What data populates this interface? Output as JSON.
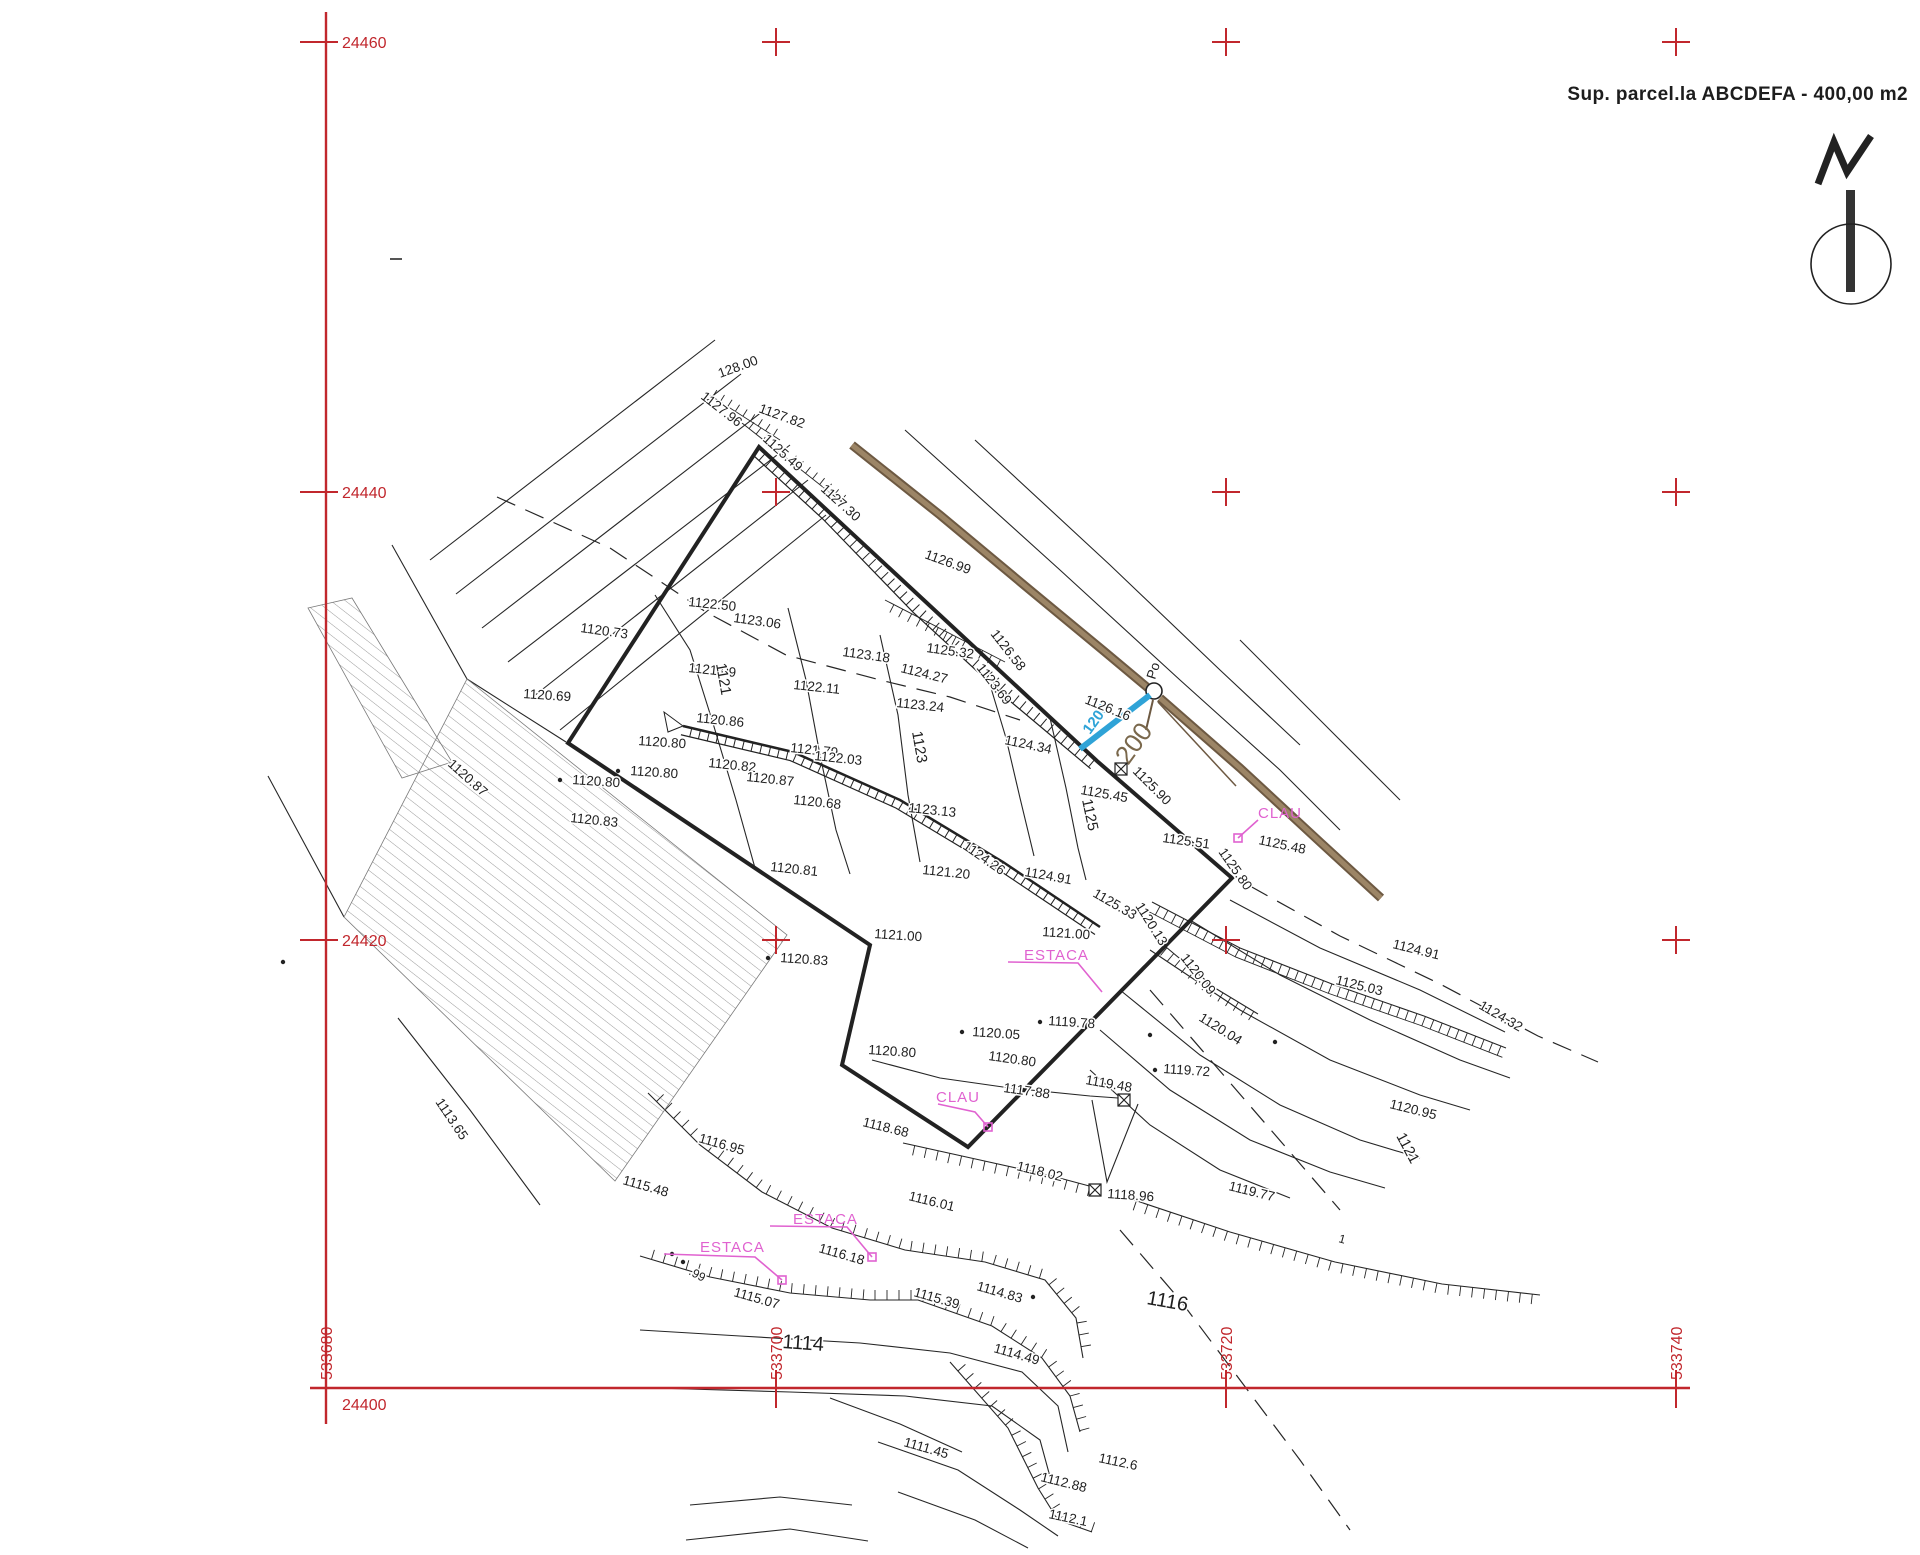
{
  "title": "Sup. parcel.la ABCDEFA - 400,00 m2",
  "parcel": {
    "name": "ABCDEFA",
    "area_label": "400,00 m2",
    "vertices": [
      [
        759,
        447
      ],
      [
        1097,
        761
      ],
      [
        1232,
        878
      ],
      [
        968,
        1147
      ],
      [
        842,
        1065
      ],
      [
        870,
        945
      ],
      [
        568,
        743
      ]
    ]
  },
  "colors": {
    "grid_red": "#c1272d",
    "ink": "#1f1f1f",
    "magenta": "#e062d0",
    "cyan": "#2fa3d7",
    "fence_dark": "#6d5942",
    "fence_light": "#9c8566",
    "brown_text": "#7a684c"
  },
  "grid": {
    "y_labels": [
      {
        "text": "24460",
        "y": 42
      },
      {
        "text": "24440",
        "y": 492
      },
      {
        "text": "24420",
        "y": 940
      },
      {
        "text": "24400",
        "y": 1388
      }
    ],
    "x_labels": [
      {
        "text": "533680",
        "x": 326
      },
      {
        "text": "533700",
        "x": 776
      },
      {
        "text": "533720",
        "x": 1226
      },
      {
        "text": "533740",
        "x": 1676
      }
    ],
    "cross_xs": [
      776,
      1226,
      1676
    ],
    "cross_ys": [
      42,
      492,
      940
    ]
  },
  "well_label": "Po",
  "blue_dim": {
    "text": "1200"
  },
  "brown_dim": {
    "text": "200"
  },
  "magenta_labels": [
    {
      "t": "CLAU",
      "x": 1258,
      "y": 818
    },
    {
      "t": "CLAU",
      "x": 936,
      "y": 1102
    },
    {
      "t": "ESTACA",
      "x": 1024,
      "y": 960
    },
    {
      "t": "ESTACA",
      "x": 793,
      "y": 1224
    },
    {
      "t": "ESTACA",
      "x": 700,
      "y": 1252
    }
  ],
  "labels": [
    {
      "t": "128.00",
      "x": 720,
      "y": 378,
      "r": -20
    },
    {
      "t": "1127.96",
      "x": 700,
      "y": 398,
      "r": 38
    },
    {
      "t": "1127.82",
      "x": 758,
      "y": 412,
      "r": 20
    },
    {
      "t": "1125.49",
      "x": 762,
      "y": 440,
      "r": 42
    },
    {
      "t": "1127.30",
      "x": 820,
      "y": 490,
      "r": 42
    },
    {
      "t": "1126.99",
      "x": 924,
      "y": 558,
      "r": 20
    },
    {
      "t": "1122.50",
      "x": 688,
      "y": 606,
      "r": 6
    },
    {
      "t": "1123.06",
      "x": 733,
      "y": 622,
      "r": 8
    },
    {
      "t": "1120.73",
      "x": 580,
      "y": 632,
      "r": 8
    },
    {
      "t": "1123.18",
      "x": 842,
      "y": 656,
      "r": 8
    },
    {
      "t": "1125.32",
      "x": 926,
      "y": 652,
      "r": 8
    },
    {
      "t": "1124.27",
      "x": 900,
      "y": 672,
      "r": 14
    },
    {
      "t": "1126.58",
      "x": 990,
      "y": 634,
      "r": 52
    },
    {
      "t": "1123.69",
      "x": 976,
      "y": 668,
      "r": 52
    },
    {
      "t": "1121.09",
      "x": 688,
      "y": 672,
      "r": 6
    },
    {
      "t": "1122.11",
      "x": 793,
      "y": 689,
      "r": 6
    },
    {
      "t": "1123.24",
      "x": 896,
      "y": 707,
      "r": 6
    },
    {
      "t": "1121",
      "x": 716,
      "y": 664,
      "r": 80,
      "s": 15
    },
    {
      "t": "1120.86",
      "x": 696,
      "y": 722,
      "r": 6
    },
    {
      "t": "1120.80",
      "x": 638,
      "y": 745,
      "r": 4
    },
    {
      "t": "1121.79",
      "x": 790,
      "y": 752,
      "r": 6
    },
    {
      "t": "1122.03",
      "x": 814,
      "y": 760,
      "r": 6
    },
    {
      "t": "1120.82",
      "x": 708,
      "y": 767,
      "r": 6
    },
    {
      "t": "1120.87",
      "x": 746,
      "y": 781,
      "r": 6
    },
    {
      "t": "1120.80",
      "x": 572,
      "y": 784,
      "r": 4
    },
    {
      "t": "1120.80",
      "x": 630,
      "y": 775,
      "r": 4
    },
    {
      "t": "1120.68",
      "x": 793,
      "y": 804,
      "r": 6
    },
    {
      "t": "1123.13",
      "x": 908,
      "y": 812,
      "r": 6
    },
    {
      "t": "1123",
      "x": 912,
      "y": 732,
      "r": 80,
      "s": 15
    },
    {
      "t": "1120.83",
      "x": 570,
      "y": 822,
      "r": 6
    },
    {
      "t": "1120.69",
      "x": 523,
      "y": 698,
      "r": 4
    },
    {
      "t": "1120.87",
      "x": 447,
      "y": 765,
      "r": 42
    },
    {
      "t": "1124.26",
      "x": 962,
      "y": 848,
      "r": 35
    },
    {
      "t": "1120.81",
      "x": 770,
      "y": 871,
      "r": 6
    },
    {
      "t": "1121.20",
      "x": 922,
      "y": 874,
      "r": 6
    },
    {
      "t": "1124.91",
      "x": 1024,
      "y": 876,
      "r": 10
    },
    {
      "t": "1125.33",
      "x": 1092,
      "y": 896,
      "r": 30
    },
    {
      "t": "1124.34",
      "x": 1004,
      "y": 744,
      "r": 12
    },
    {
      "t": "1126.16",
      "x": 1084,
      "y": 703,
      "r": 22
    },
    {
      "t": "1125.45",
      "x": 1080,
      "y": 794,
      "r": 10
    },
    {
      "t": "1125",
      "x": 1082,
      "y": 800,
      "r": 78,
      "s": 15
    },
    {
      "t": "1125.90",
      "x": 1132,
      "y": 772,
      "r": 45
    },
    {
      "t": "1125.51",
      "x": 1162,
      "y": 842,
      "r": 8
    },
    {
      "t": "1125.48",
      "x": 1258,
      "y": 844,
      "r": 12
    },
    {
      "t": "1125.80",
      "x": 1218,
      "y": 852,
      "r": 55
    },
    {
      "t": "1121.00",
      "x": 874,
      "y": 938,
      "r": 4
    },
    {
      "t": "1121.00",
      "x": 1042,
      "y": 936,
      "r": 4
    },
    {
      "t": "1120.13",
      "x": 1135,
      "y": 906,
      "r": 58
    },
    {
      "t": "1120.09",
      "x": 1180,
      "y": 958,
      "r": 52
    },
    {
      "t": "1120.04",
      "x": 1198,
      "y": 1020,
      "r": 32
    },
    {
      "t": "1119.72",
      "x": 1163,
      "y": 1073,
      "r": 4
    },
    {
      "t": "1119.48",
      "x": 1085,
      "y": 1084,
      "r": 10
    },
    {
      "t": "1119.78",
      "x": 1048,
      "y": 1025,
      "r": 4
    },
    {
      "t": "1120.05",
      "x": 972,
      "y": 1036,
      "r": 4
    },
    {
      "t": "1120.80",
      "x": 868,
      "y": 1054,
      "r": 4
    },
    {
      "t": "1120.80",
      "x": 988,
      "y": 1060,
      "r": 8
    },
    {
      "t": "1117.88",
      "x": 1003,
      "y": 1092,
      "r": 8
    },
    {
      "t": "1120.83",
      "x": 780,
      "y": 962,
      "r": 4
    },
    {
      "t": "1118.68",
      "x": 862,
      "y": 1126,
      "r": 14
    },
    {
      "t": "1124.91",
      "x": 1392,
      "y": 948,
      "r": 14
    },
    {
      "t": "1125.03",
      "x": 1335,
      "y": 984,
      "r": 14
    },
    {
      "t": "1124.32",
      "x": 1478,
      "y": 1008,
      "r": 30
    },
    {
      "t": "1120.95",
      "x": 1389,
      "y": 1108,
      "r": 14
    },
    {
      "t": "1121",
      "x": 1396,
      "y": 1136,
      "r": 62,
      "s": 15
    },
    {
      "t": "1118.96",
      "x": 1107,
      "y": 1198,
      "r": 4
    },
    {
      "t": "1119.77",
      "x": 1228,
      "y": 1190,
      "r": 14
    },
    {
      "t": "1118.02",
      "x": 1016,
      "y": 1170,
      "r": 14
    },
    {
      "t": "1116.95",
      "x": 698,
      "y": 1142,
      "r": 16
    },
    {
      "t": "1115.48",
      "x": 622,
      "y": 1184,
      "r": 16
    },
    {
      "t": "1113.65",
      "x": 435,
      "y": 1102,
      "r": 56
    },
    {
      "t": "1116.18",
      "x": 818,
      "y": 1252,
      "r": 16
    },
    {
      "t": "1116.01",
      "x": 908,
      "y": 1200,
      "r": 14
    },
    {
      "t": ".99",
      "x": 688,
      "y": 1274,
      "r": 28,
      "s": 12
    },
    {
      "t": "1115.07",
      "x": 733,
      "y": 1296,
      "r": 16
    },
    {
      "t": "1115.39",
      "x": 913,
      "y": 1296,
      "r": 16
    },
    {
      "t": "1114.83",
      "x": 976,
      "y": 1290,
      "r": 16
    },
    {
      "t": "1114.49",
      "x": 993,
      "y": 1352,
      "r": 16
    },
    {
      "t": "1114",
      "x": 782,
      "y": 1348,
      "r": 4,
      "s": 20
    },
    {
      "t": "1116",
      "x": 1146,
      "y": 1304,
      "r": 10,
      "s": 20
    },
    {
      "t": "1111.45",
      "x": 903,
      "y": 1446,
      "r": 16
    },
    {
      "t": "1112.88",
      "x": 1040,
      "y": 1481,
      "r": 14
    },
    {
      "t": "1112.6",
      "x": 1098,
      "y": 1462,
      "r": 12
    },
    {
      "t": "1112.1",
      "x": 1048,
      "y": 1518,
      "r": 12
    },
    {
      "t": "1",
      "x": 1338,
      "y": 1242,
      "r": 15,
      "s": 12
    }
  ],
  "point_dots": [
    [
      560,
      780
    ],
    [
      618,
      771
    ],
    [
      768,
      958
    ],
    [
      962,
      1032
    ],
    [
      1040,
      1022
    ],
    [
      1155,
      1070
    ],
    [
      1033,
      1297
    ],
    [
      683,
      1262
    ],
    [
      672,
      1254
    ],
    [
      1150,
      1035
    ],
    [
      1275,
      1042
    ],
    [
      283,
      962
    ]
  ]
}
